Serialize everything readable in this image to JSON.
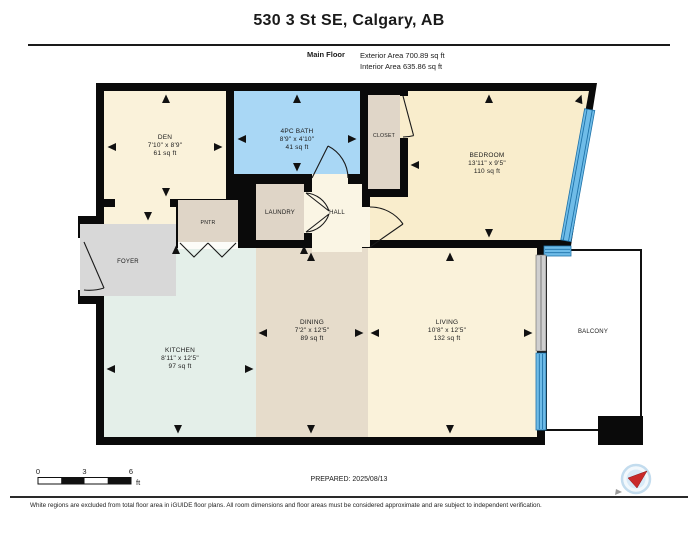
{
  "header": {
    "title": "530 3 St SE, Calgary, AB",
    "floor_label": "Main Floor",
    "exterior_area": "Exterior Area 700.89 sq ft",
    "interior_area": "Interior Area 635.86 sq ft"
  },
  "rooms": {
    "den": {
      "name": "DEN",
      "dims": "7'10\" x 8'9\"",
      "area": "61 sq ft"
    },
    "bath": {
      "name": "4PC BATH",
      "dims": "8'9\" x 4'10\"",
      "area": "41 sq ft"
    },
    "closet": {
      "name": "CLOSET"
    },
    "bedroom": {
      "name": "BEDROOM",
      "dims": "13'11\" x 9'5\"",
      "area": "110 sq ft"
    },
    "pntr": {
      "name": "PNTR"
    },
    "laundry": {
      "name": "LAUNDRY"
    },
    "hall": {
      "name": "HALL"
    },
    "foyer": {
      "name": "FOYER"
    },
    "kitchen": {
      "name": "KITCHEN",
      "dims": "8'11\" x 12'5\"",
      "area": "97 sq ft"
    },
    "dining": {
      "name": "DINING",
      "dims": "7'2\" x 12'5\"",
      "area": "89 sq ft"
    },
    "living": {
      "name": "LIVING",
      "dims": "10'8\" x 12'5\"",
      "area": "132 sq ft"
    },
    "balcony": {
      "name": "BALCONY"
    }
  },
  "scale_bar": {
    "t0": "0",
    "t3": "3",
    "t6": "6",
    "unit": "ft"
  },
  "footer": {
    "prepared": "PREPARED: 2025/08/13",
    "disclaimer": "White regions are excluded from total floor area in iGUIDE floor plans. All room dimensions and floor areas must be considered approximate and are subject to independent verification."
  },
  "colors": {
    "wall": "#0a0a0a",
    "room_cream": "#faf2da",
    "bedroom_fill": "#f9edcc",
    "bath_fill": "#a9d7f5",
    "tan_fill": "#dfd5c7",
    "dining_fill": "#e6dccb",
    "kitchen_fill": "#e4efe9",
    "foyer_fill": "#d8d8d8",
    "window_blue": "#6fbce8",
    "window_stripe": "#1f72a8",
    "compass_red": "#c92a2a"
  }
}
